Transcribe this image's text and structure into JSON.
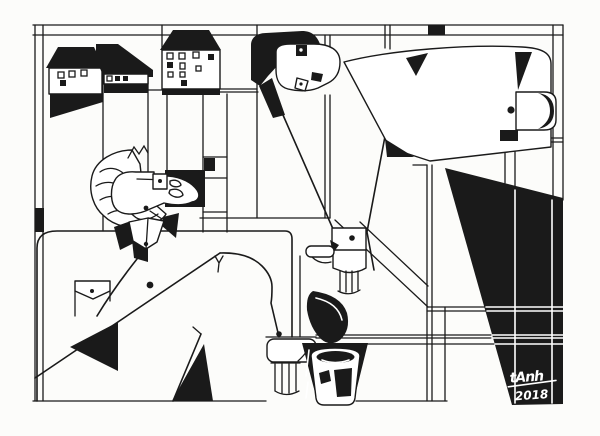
{
  "artwork": {
    "signature": "tAnh",
    "year": "2018",
    "colors": {
      "ink": "#1a1a1a",
      "paper": "#fcfcfa"
    }
  }
}
